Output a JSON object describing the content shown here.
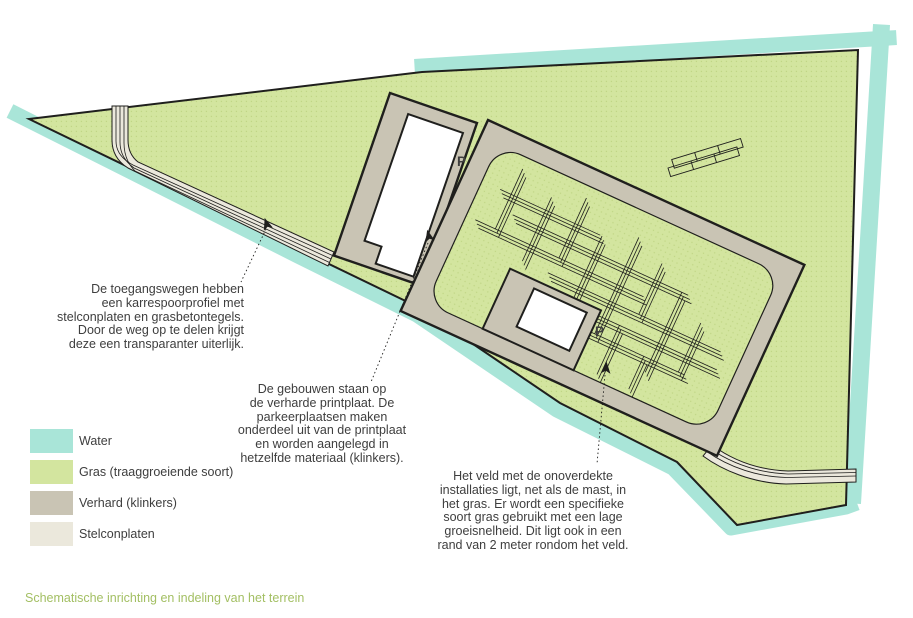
{
  "colors": {
    "water": "#a9e5d8",
    "grass": "#d3e59f",
    "grassdot": "#bfd584",
    "paved": "#c9c4b4",
    "stelcon": "#ebe8dc",
    "building": "#ffffff",
    "outline": "#1f1f1d",
    "ink": "#3e3e3e",
    "caption": "#a3bf63"
  },
  "annotations": {
    "access_roads": "De toegangswegen hebben\neen karrespoorprofiel met\nstelconplaten en grasbetontegels.\nDoor de weg op te delen krijgt\ndeze een transparanter uiterlijk.",
    "buildings": "De gebouwen staan op\nde verharde printplaat. De\nparkeerplaatsen maken\nonderdeel uit van de printplaat\nen worden aangelegd in\nhetzelfde materiaal (klinkers).",
    "field": "Het veld met de onoverdekte\ninstallaties ligt, net als de mast, in\nhet gras. Er wordt een specifieke\nsoort gras gebruikt met een lage\ngroeisnelheid. Dit ligt ook in een\nrand van 2 meter rondom het veld."
  },
  "labels": {
    "parking_west": "P",
    "parking_east": "P"
  },
  "legend": {
    "items": [
      {
        "label": "Water",
        "color_key": "water"
      },
      {
        "label": "Gras (traaggroeiende soort)",
        "color_key": "grass"
      },
      {
        "label": "Verhard (klinkers)",
        "color_key": "paved"
      },
      {
        "label": "Stelconplaten",
        "color_key": "stelcon"
      }
    ]
  },
  "caption": "Schematische inrichting en indeling van het terrein"
}
